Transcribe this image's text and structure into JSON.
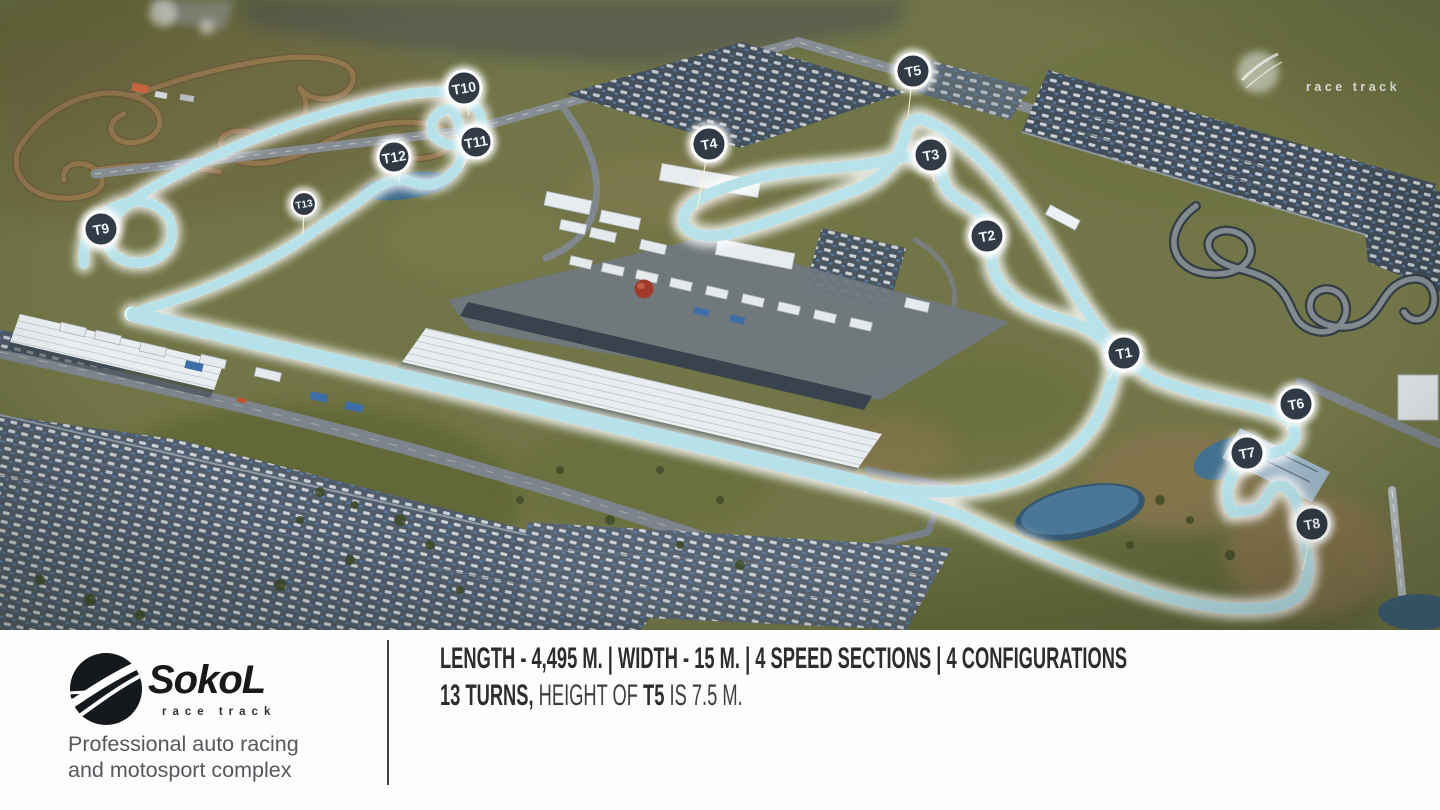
{
  "map": {
    "watermark": {
      "label": "race track"
    },
    "accent_colors": {
      "track_glow": "#eafbfc",
      "track_hatch": "#8ecdd8",
      "marker_fill": "#222c38",
      "pond": "#4a7697",
      "terrain": "#717547"
    },
    "turn_markers": [
      {
        "id": "T1",
        "x": 1124,
        "y": 353,
        "tx": 1108,
        "ty": 380,
        "r": 17
      },
      {
        "id": "T2",
        "x": 987,
        "y": 236,
        "tx": 991,
        "ty": 258,
        "r": 17
      },
      {
        "id": "T3",
        "x": 931,
        "y": 155,
        "tx": 934,
        "ty": 182,
        "r": 17
      },
      {
        "id": "T4",
        "x": 709,
        "y": 144,
        "tx": 697,
        "ty": 210,
        "r": 17
      },
      {
        "id": "T5",
        "x": 913,
        "y": 71,
        "tx": 908,
        "ty": 116,
        "r": 17
      },
      {
        "id": "T6",
        "x": 1296,
        "y": 404,
        "tx": 1287,
        "ty": 430,
        "r": 17
      },
      {
        "id": "T7",
        "x": 1247,
        "y": 453,
        "tx": 1238,
        "ty": 471,
        "r": 17
      },
      {
        "id": "T8",
        "x": 1312,
        "y": 524,
        "tx": 1303,
        "ty": 570,
        "r": 17
      },
      {
        "id": "T9",
        "x": 101,
        "y": 229,
        "tx": 113,
        "ty": 243,
        "r": 17
      },
      {
        "id": "T10",
        "x": 464,
        "y": 88,
        "tx": 469,
        "ty": 116,
        "r": 17
      },
      {
        "id": "T11",
        "x": 476,
        "y": 142,
        "tx": 462,
        "ty": 168,
        "r": 16
      },
      {
        "id": "T12",
        "x": 394,
        "y": 157,
        "tx": 400,
        "ty": 183,
        "r": 16
      },
      {
        "id": "T13",
        "x": 304,
        "y": 204,
        "tx": 303,
        "ty": 234,
        "r": 12
      }
    ]
  },
  "footer": {
    "brand": "SokoL",
    "brand_subtitle": "race track",
    "tagline_line1": "Professional auto racing",
    "tagline_line2": "and motosport complex",
    "stats_line1": "LENGTH - 4,495 M. | WIDTH - 15 M. | 4 SPEED SECTIONS | 4 CONFIGURATIONS",
    "stats_line2": {
      "b1": "13 TURNS,",
      "r1": " HEIGHT OF ",
      "b2": "T5",
      "r2": " IS 7.5 M."
    }
  }
}
